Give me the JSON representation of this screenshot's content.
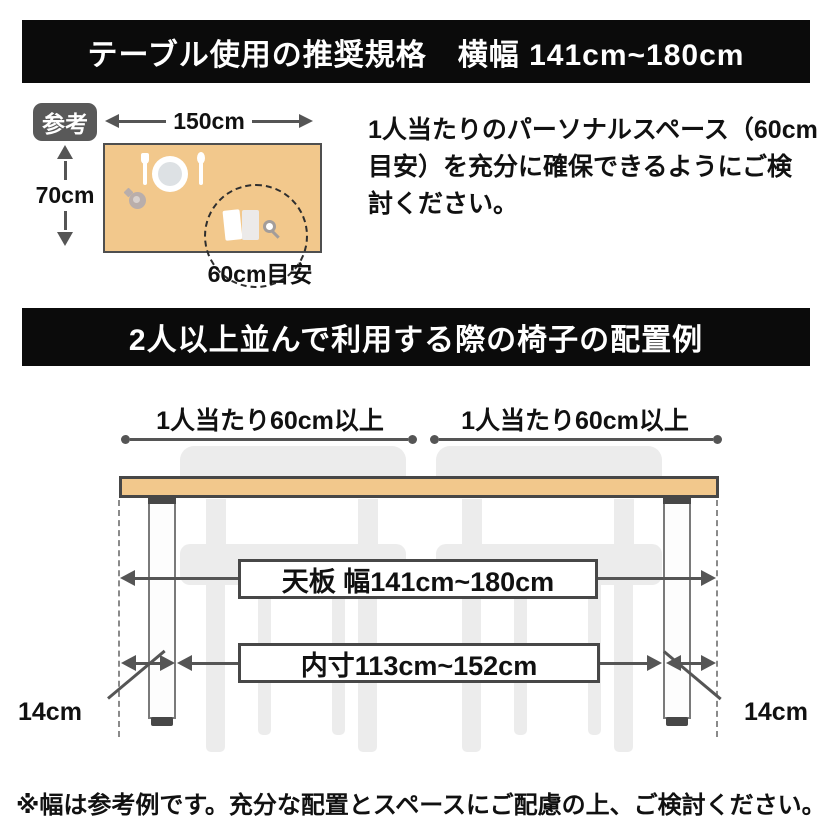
{
  "colors": {
    "banner_bg": "#0b0b0b",
    "banner_text": "#ffffff",
    "table_fill": "#f2c88c",
    "outline_dark": "#474747",
    "arrow_gray": "#555555",
    "badge_bg": "#595959",
    "chair_gray": "#ececec",
    "text_black": "#111111"
  },
  "banner_top": {
    "text": "テーブル使用の推奨規格　横幅 141cm~180cm"
  },
  "reference": {
    "badge_label": "参考",
    "table_width_label": "150cm",
    "table_depth_label": "70cm",
    "personal_space_label": "60cm目安",
    "note_lines": [
      "1人当たりのパーソナルスペース（60cm",
      "目安）を充分に確保できるようにご検",
      "討ください。"
    ]
  },
  "banner_middle": {
    "text": "2人以上並んで利用する際の椅子の配置例"
  },
  "arrangement": {
    "per_person_left": "1人当たり60cm以上",
    "per_person_right": "1人当たり60cm以上",
    "tabletop_width_label": "天板 幅141cm~180cm",
    "inner_width_label": "内寸113cm~152cm",
    "leg_offset_left": "14cm",
    "leg_offset_right": "14cm"
  },
  "footer": {
    "note": "※幅は参考例です。充分な配置とスペースにご配慮の上、ご検討ください。"
  }
}
